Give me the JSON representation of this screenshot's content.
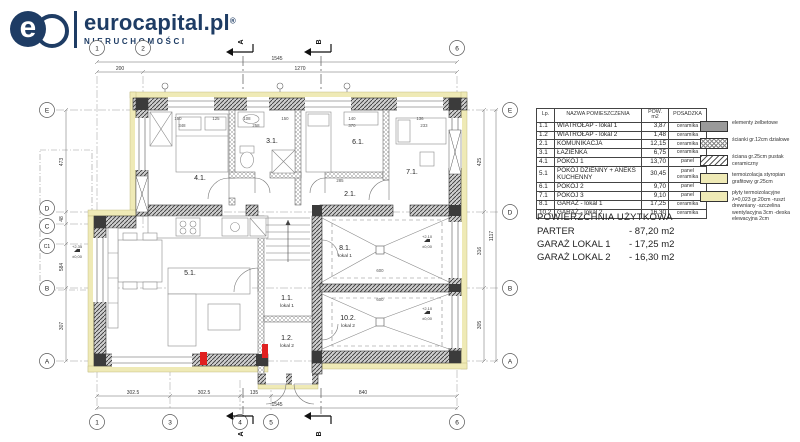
{
  "logo": {
    "mark_e": "e",
    "brand": "eurocapital.pl",
    "reg": "®",
    "subtitle": "NIERUCHOMOŚCI"
  },
  "colors": {
    "navy": "#1e3c64",
    "insulation": "#efeab6",
    "wall_dark": "#3b3b3b",
    "red_accent": "#e02020"
  },
  "room_table": {
    "headers": {
      "lp": "Lp.",
      "name": "NAZWA POMIESZCZENIA",
      "area": "POW. m2",
      "floor": "POSADZKA"
    },
    "rows": [
      {
        "lp": "1.1",
        "name": "WIATROŁAP - lokal 1",
        "area": "3,87",
        "floor": "ceramika"
      },
      {
        "lp": "1.2",
        "name": "WIATROŁAP - lokal 2",
        "area": "1,48",
        "floor": "ceramika"
      },
      {
        "lp": "2.1",
        "name": "KOMUNIKACJA",
        "area": "12,15",
        "floor": "ceramika"
      },
      {
        "lp": "3.1",
        "name": "ŁAZIENKA",
        "area": "6,75",
        "floor": "ceramika"
      },
      {
        "lp": "4.1",
        "name": "POKÓJ 1",
        "area": "13,70",
        "floor": "panel"
      },
      {
        "lp": "5.1",
        "name": "POKÓJ DZIENNY + ANEKS KUCHENNY",
        "area": "30,45",
        "floor": "panel ceramika"
      },
      {
        "lp": "6.1",
        "name": "POKÓJ 2",
        "area": "9,70",
        "floor": "panel"
      },
      {
        "lp": "7.1",
        "name": "POKÓJ 3",
        "area": "9,10",
        "floor": "panel"
      },
      {
        "lp": "8.1",
        "name": "GARAŻ - lokal 1",
        "area": "17,25",
        "floor": "ceramika"
      },
      {
        "lp": "10.2",
        "name": "GARAŻ - lokal 2",
        "area": "16,30",
        "floor": "ceramika"
      }
    ]
  },
  "legend": {
    "items": [
      {
        "swatch": "concrete",
        "label": "elementy żelbetowe"
      },
      {
        "swatch": "cross",
        "label": "ścianki gr.12cm działowe"
      },
      {
        "swatch": "diag",
        "label": "ściana gr.25cm pustak ceramiczny"
      },
      {
        "swatch": "insul",
        "label": "termoizolacja styropian grafitowy gr.25cm"
      },
      {
        "swatch": "insul",
        "label": "płyty termoizolacyjne λ=0,023 gr.20cm -ruszt drewniany -szczelina wentylacyjna 3cm -deska elewacyjna 2cm"
      }
    ]
  },
  "summary": {
    "title": "POWIERZCHNIA UŻYTKOWA",
    "lines": [
      {
        "label": "PARTER",
        "value": "- 87,20 m2"
      },
      {
        "label": "GARAŻ LOKAL 1",
        "value": "- 17,25 m2"
      },
      {
        "label": "GARAŻ LOKAL 2",
        "value": "- 16,30 m2"
      }
    ]
  },
  "plan": {
    "rooms": {
      "r41": "4.1.",
      "r31": "3.1.",
      "r61": "6.1.",
      "r71": "7.1.",
      "r21": "2.1.",
      "r51": "5.1.",
      "r81": "8.1.",
      "r81s": "lokal 1",
      "r102": "10.2.",
      "r102s": "lokal 2",
      "r11": "1.1.",
      "r11s": "lokal 1",
      "r12": "1.2.",
      "r12s": "lokal 2"
    },
    "bubbles": {
      "n1": "1",
      "n2": "2",
      "n3": "3",
      "n4": "4",
      "n5": "5",
      "n6": "6",
      "E": "E",
      "D": "D",
      "C": "C",
      "C1": "C1",
      "B": "B",
      "A": "A"
    },
    "sections": {
      "a": "A",
      "b": "B"
    },
    "dims": {
      "d200": "200",
      "d1545": "1545",
      "d1270": "1270",
      "d3025": "302.5",
      "d135": "135",
      "d840": "840",
      "d425": "425",
      "d316": "316",
      "d305": "305",
      "d1117": "1117",
      "d473": "473",
      "d48": "48",
      "d584": "584",
      "d307": "307",
      "d150": "150",
      "d125": "125",
      "d108": "108",
      "d140": "140",
      "d136": "136",
      "d348": "348",
      "d258": "258",
      "d370": "370",
      "d233": "233",
      "d600": "600",
      "d285": "285"
    },
    "elev": {
      "e235": "+2,35",
      "e000": "±0,00",
      "e210": "+2,10"
    }
  }
}
